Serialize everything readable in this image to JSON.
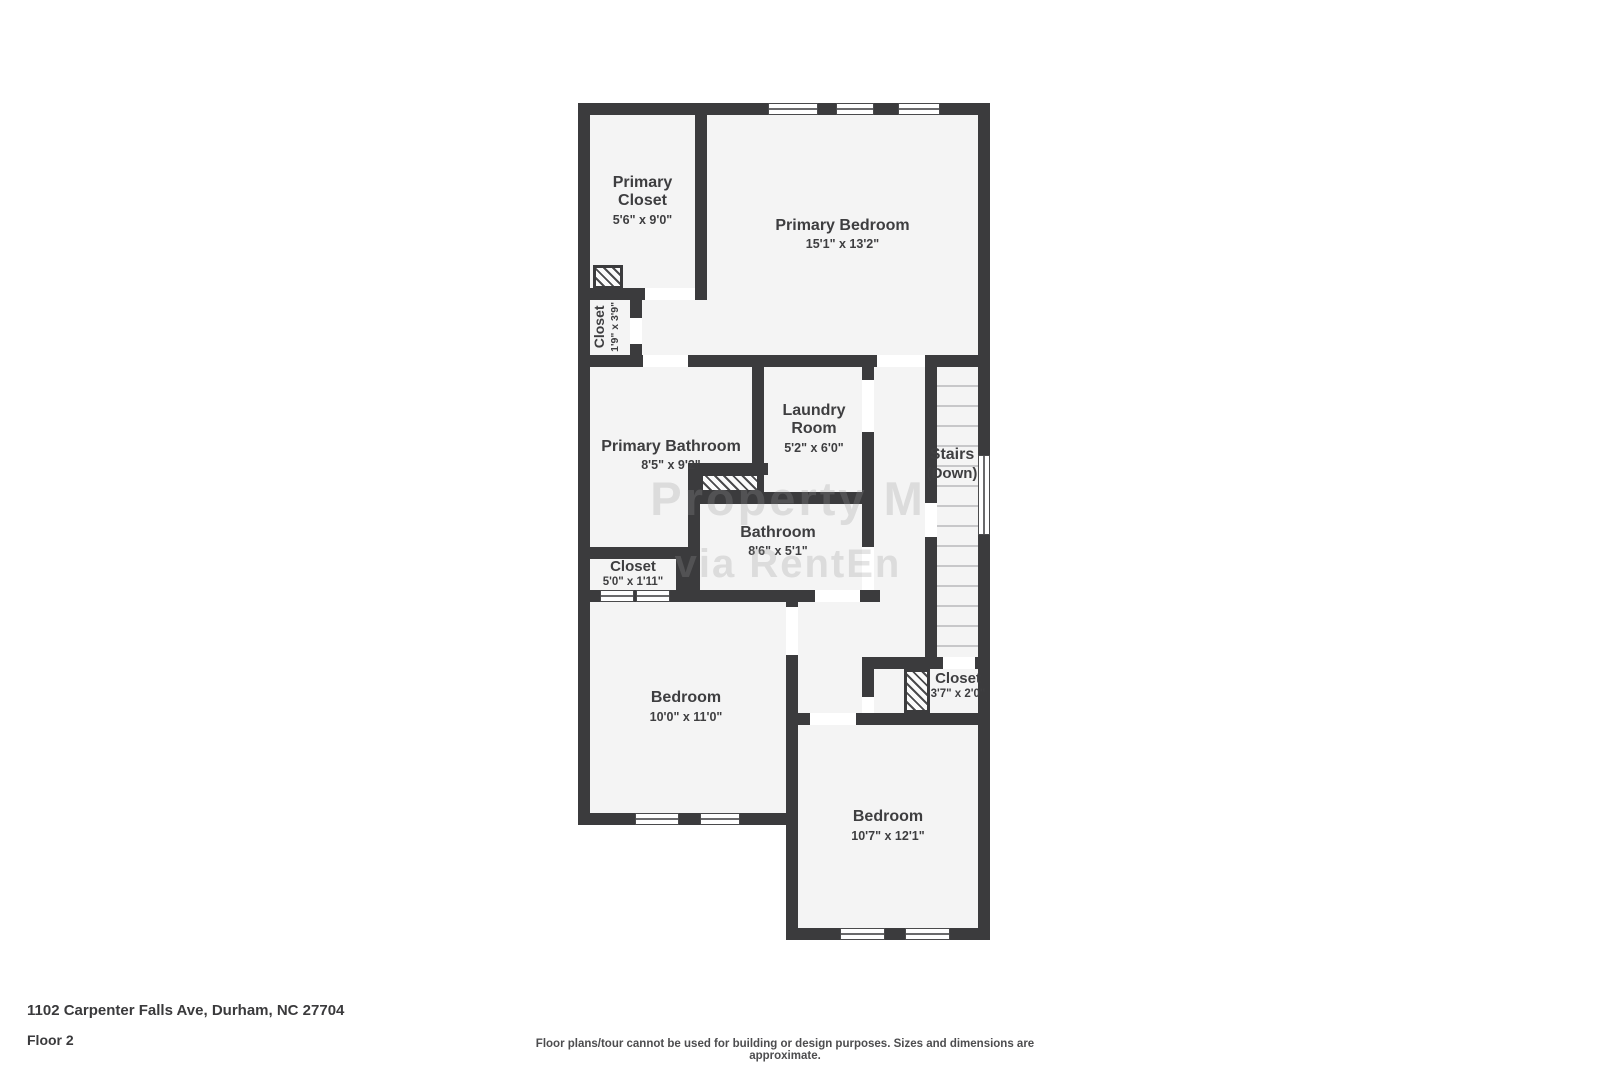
{
  "footer": {
    "address": "1102 Carpenter Falls Ave, Durham, NC 27704",
    "floor_label": "Floor 2",
    "disclaimer": "Floor plans/tour cannot be used for building or design purposes. Sizes and dimensions are approximate."
  },
  "watermark": {
    "line1": "Property M",
    "line2": "via RentEn"
  },
  "colors": {
    "wall": "#3b3b3d",
    "room_fill": "#f4f4f4",
    "label_text": "#3e3e40"
  },
  "rooms": [
    {
      "id": "primary-closet",
      "name": "Primary Closet",
      "dims": "5'6\" x 9'0\""
    },
    {
      "id": "primary-bedroom",
      "name": "Primary Bedroom",
      "dims": "15'1\" x 13'2\""
    },
    {
      "id": "closet-left",
      "name": "Closet",
      "dims": "1'9\" x 3'9\""
    },
    {
      "id": "primary-bathroom",
      "name": "Primary Bathroom",
      "dims": "8'5\" x 9'2\""
    },
    {
      "id": "laundry-room",
      "name": "Laundry Room",
      "dims": "5'2\" x 6'0\""
    },
    {
      "id": "stairs",
      "name": "Stairs",
      "dims": "(Down)"
    },
    {
      "id": "bathroom",
      "name": "Bathroom",
      "dims": "8'6\" x 5'1\""
    },
    {
      "id": "closet-hall",
      "name": "Closet",
      "dims": "5'0\" x 1'11\""
    },
    {
      "id": "bedroom-left",
      "name": "Bedroom",
      "dims": "10'0\" x 11'0\""
    },
    {
      "id": "closet-right",
      "name": "Closet",
      "dims": "3'7\" x 2'0\""
    },
    {
      "id": "bedroom-right",
      "name": "Bedroom",
      "dims": "10'7\" x 12'1\""
    }
  ]
}
